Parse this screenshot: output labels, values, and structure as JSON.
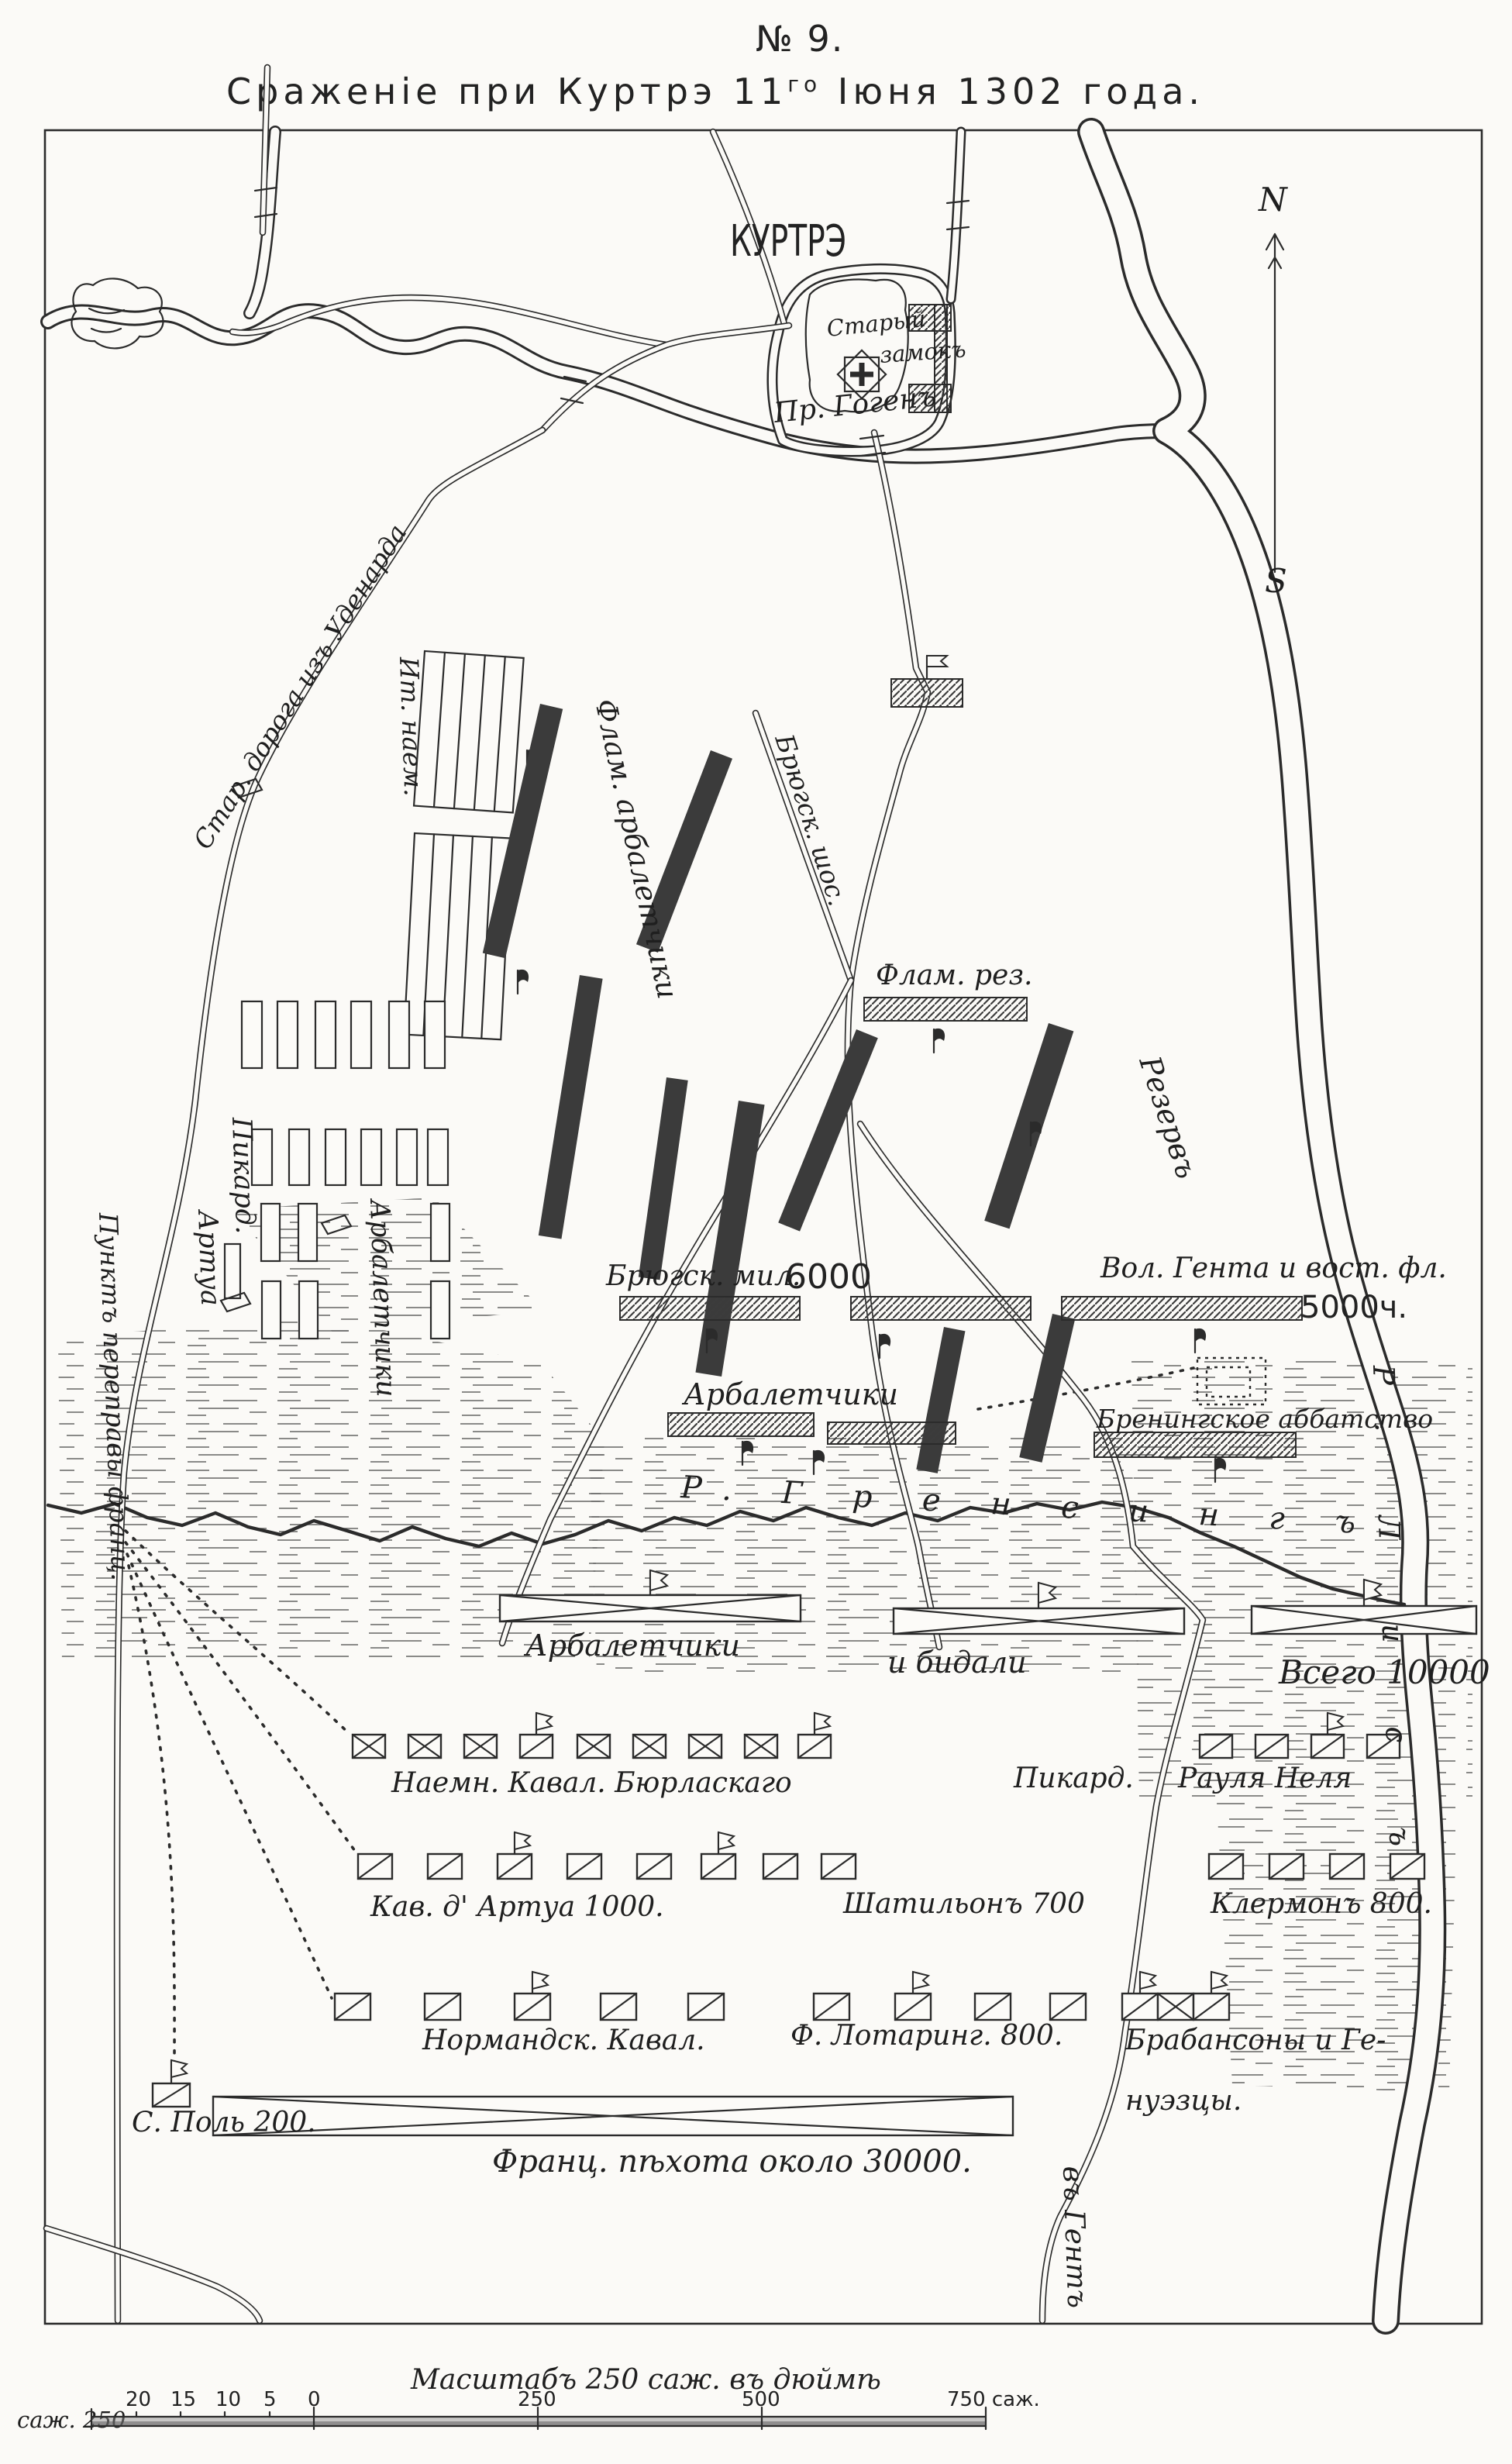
{
  "title": {
    "no": "№ 9.",
    "main_pre": "Сраженіе при Куртрэ 11",
    "main_sup": "го",
    "main_post": " Іюня 1302 года."
  },
  "compass": {
    "n": "N",
    "s": "S"
  },
  "city": {
    "name": "КУРТРЭ",
    "old_castle_1": "Старый",
    "old_castle_2": "замокъ"
  },
  "waters": {
    "gogen": "Пр. Гогенъ",
    "groening": "Р.  Г р е н с и н г ъ",
    "lys": "Р. Л и с ъ"
  },
  "roads": {
    "oudenaarde": "Стар. дорога изъ Уденарда",
    "bruges": "Брюгск. шос.",
    "to_ghent": "въ Гентъ",
    "crossing_point": "Пунктъ переправы франц."
  },
  "flemish": {
    "italian": "Ит. наем.",
    "crossbowmen_flam": "Флам. арбалетчики",
    "reserve_small": "Флам. рез.",
    "reserve_big": "Резервъ",
    "bruges_militia": "Брюгск. мил.",
    "bruges_militia_count": "6000",
    "ghent": "Вол. Гента и вост. фл.",
    "ghent_count": "5000ч.",
    "crossbowmen_center": "Арбалетчики",
    "abbey": "Бренингское аббатство",
    "picard": "Пикард.",
    "artois": "Артуа",
    "crossbowmen_left": "Арбалетчики",
    "second_line_1": "Арбалетчики",
    "second_line_2": "и  бидали",
    "total": "Всего 10000"
  },
  "french": {
    "row1_left": "Наемн. Кавал. Бюрласкаго",
    "row1_mid": "Пикард.",
    "row1_right": "Рауля Неля",
    "row2_left": "Кав. д' Артуа 1000.",
    "row2_mid": "Шатильонъ 700",
    "row2_right": "Клермонъ 800.",
    "row3_left": "Нормандск. Кавал.",
    "row3_mid": "Ф. Лотаринг. 800.",
    "row3_right1": "Брабансоны и Ге-",
    "row3_right2": "нуэзцы.",
    "st_pol": "С. Поль 200.",
    "infantry": "Франц. пѣхота около 30000."
  },
  "scale": {
    "caption": "Масштабъ 250 саж. въ дюймѣ",
    "left_label": "саж. 250",
    "ticks": [
      "20",
      "15",
      "10",
      "5",
      "0",
      "250",
      "500",
      "750 саж."
    ]
  }
}
